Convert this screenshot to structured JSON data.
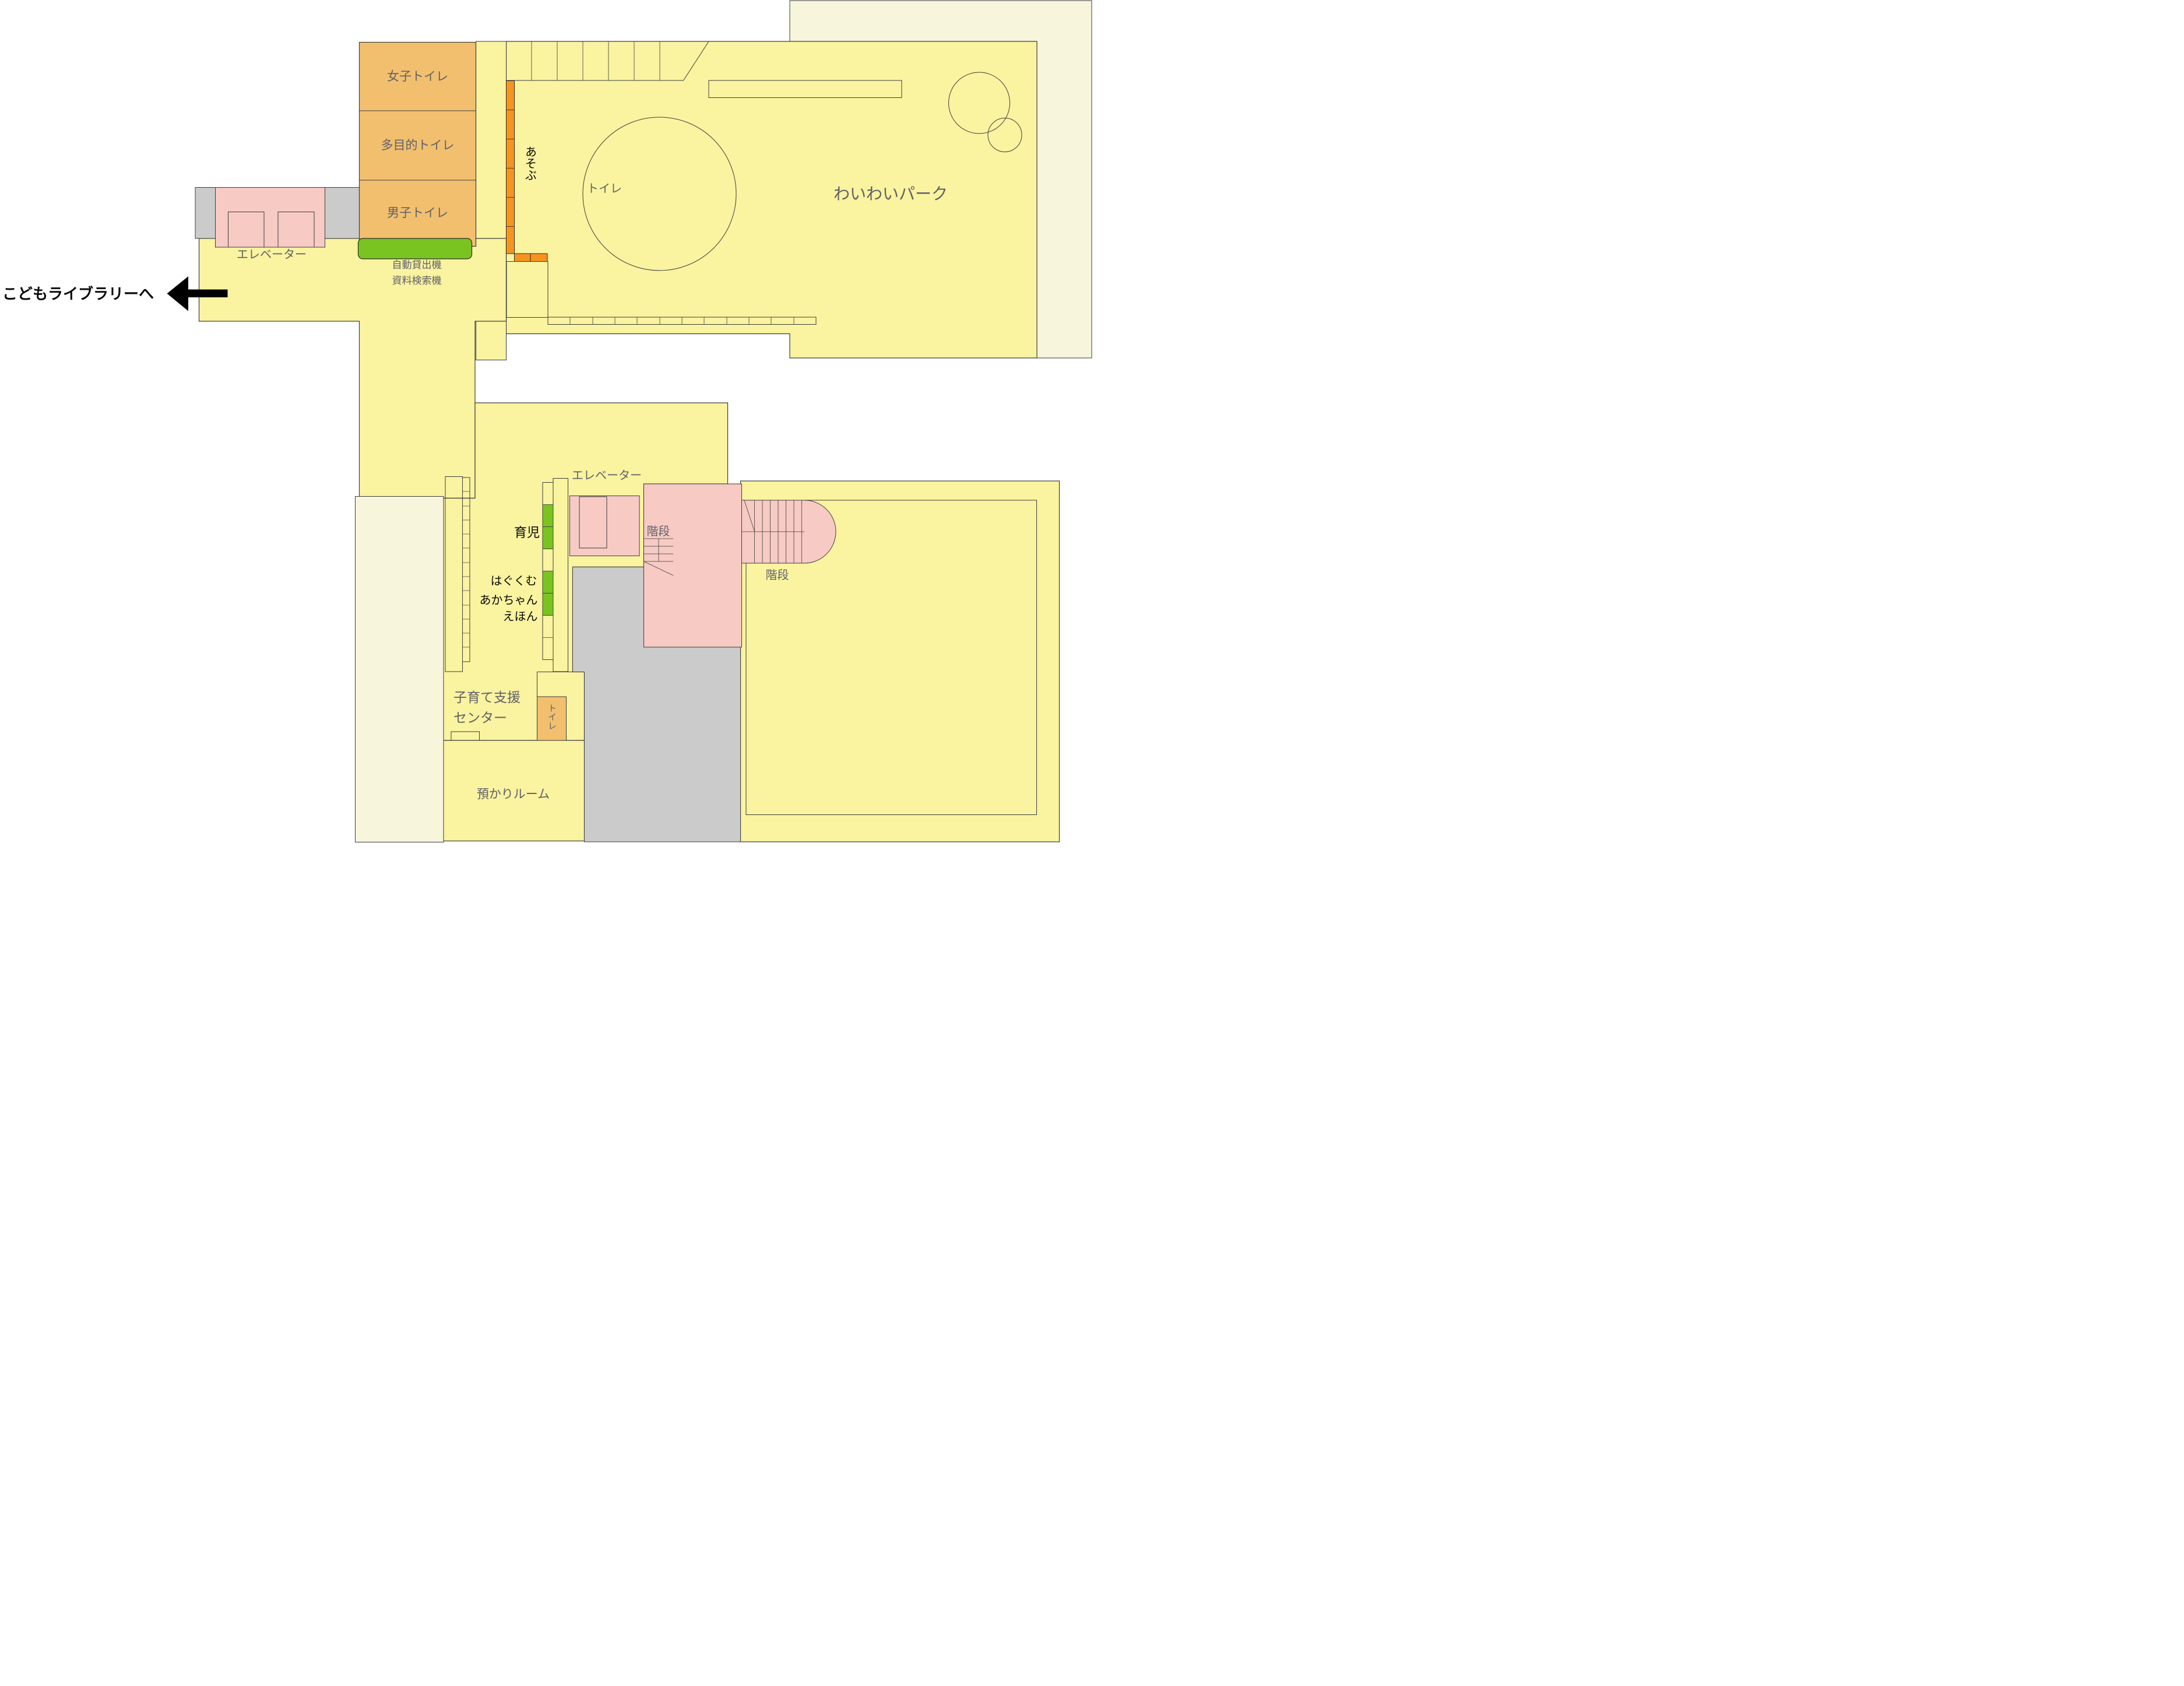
{
  "title": "library-children-floor-map",
  "colors": {
    "bright_yellow": "#FAF3A0",
    "pale_yellow": "#F7F5DC",
    "orange_room": "#F2BF6E",
    "orange_shelf": "#F7941E",
    "green_shelf": "#79C420",
    "pink_block": "#F7CAC4",
    "gray_block": "#CBCBCB",
    "wall_line": "#3d3d3d",
    "label_gray": "#5f6068",
    "label_black": "#0a0a0a",
    "arrow_black": "#000000"
  },
  "labels": {
    "womens_toilet": "女子トイレ",
    "multipurpose_toilet": "多目的トイレ",
    "mens_toilet": "男子トイレ",
    "elevator_upper": "エレベーター",
    "auto_lending_line1": "自動貸出機",
    "auto_lending_line2": "資料検索機",
    "to_kids_library": "こどもライブラリーへ",
    "asobu": "あそぶ",
    "toilet_circle": "トイレ",
    "waiwai_park": "わいわいパーク",
    "elevator_lower": "エレベーター",
    "stairs_left": "階段",
    "stairs_right": "階段",
    "ikuji": "育児",
    "hagukumu": "はぐくむ",
    "akachan": "あかちゃん",
    "ehon": "えほん",
    "kosodate_line1": "子育て支援",
    "kosodate_line2": "センター",
    "toilet_lower": "トイレ",
    "azukari_room": "預かりルーム"
  }
}
